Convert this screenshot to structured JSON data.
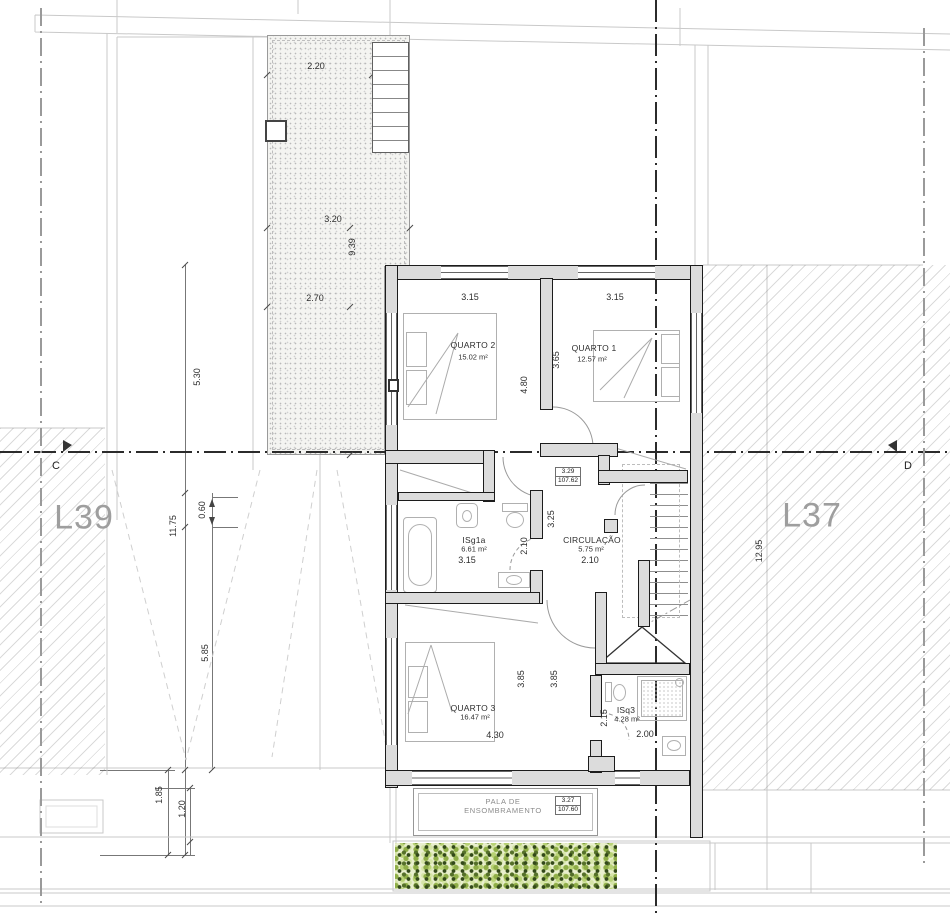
{
  "lots": {
    "left": "L39",
    "right": "L37"
  },
  "section_markers": {
    "left": "C",
    "right": "D"
  },
  "site_dims": {
    "patio_top": "2.20",
    "patio_mid": "3.20",
    "patio_height": "9.39",
    "patio_low": "2.70",
    "left_upper": "5.30",
    "left_total": "11.75",
    "left_offset": "0.60",
    "left_lower": "5.85",
    "left_margin": "1.85",
    "left_setback": "1.20",
    "right_total": "12.95"
  },
  "rooms": {
    "quarto2": {
      "name": "QUARTO 2",
      "area": "15.02 m²",
      "width": "3.15",
      "depth": "4.80"
    },
    "quarto1": {
      "name": "QUARTO 1",
      "area": "12.57 m²",
      "width": "3.15",
      "depth": "3.65"
    },
    "isg1a": {
      "name": "ISg1a",
      "area": "6.61 m²",
      "width": "3.15",
      "depth": "2.10"
    },
    "circulacao": {
      "name": "CIRCULAÇÃO",
      "area": "5.75 m²",
      "width": "2.10",
      "depth": "3.25"
    },
    "quarto3": {
      "name": "QUARTO 3",
      "area": "16.47 m²",
      "width": "4.30",
      "depth_left": "3.85",
      "depth_right": "3.85"
    },
    "isq3": {
      "name": "ISq3",
      "area": "4.28 m²",
      "width": "2.00",
      "depth": "2.15"
    }
  },
  "levels": {
    "floor": {
      "rel": "3.29",
      "abs": "107.62"
    },
    "canopy": {
      "rel": "3.27",
      "abs": "107.60"
    }
  },
  "canopy": {
    "line1": "PALA DE",
    "line2": "ENSOMBRAMENTO"
  }
}
